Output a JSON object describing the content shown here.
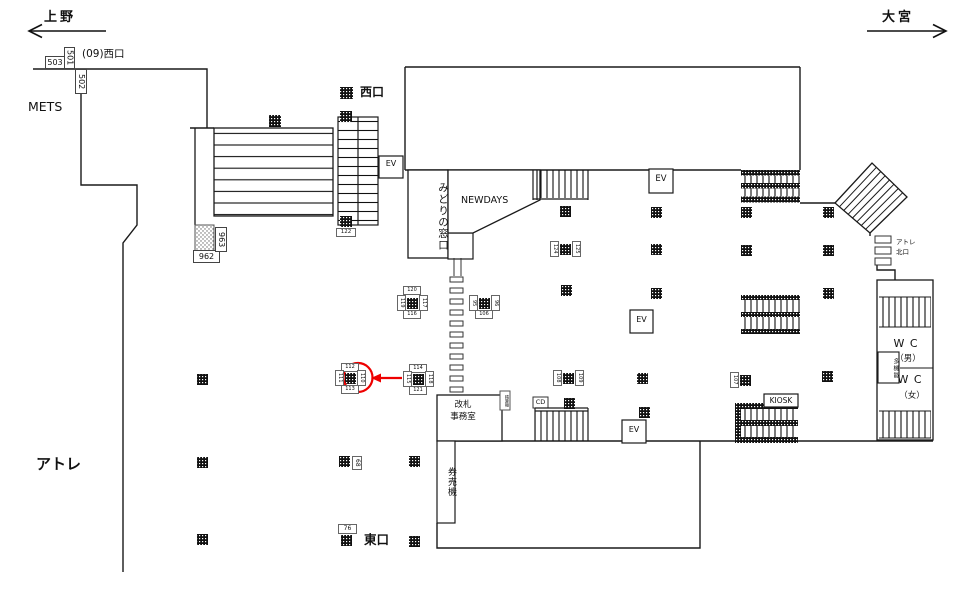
{
  "colors": {
    "wall": "#1a1a1a",
    "annotation": "#ee0000"
  },
  "directions": {
    "left": "上野",
    "right": "大宮"
  },
  "exits": {
    "west_note": "(09)西口",
    "west": "西口",
    "east": "東口"
  },
  "areas": {
    "mets": "METS",
    "atre": "アトレ",
    "atre_north_1": "アトレ",
    "atre_north_2": "北口",
    "midori": "みどりの窓口",
    "newdays": "NEWDAYS",
    "office": "改札\n事務室",
    "fare_adjust": "精算機",
    "ticket_machines": "券売機",
    "kiosk": "KIOSK",
    "cd": "CD",
    "ev": "EV",
    "wc": "W C",
    "wc_men": "（男）",
    "wc_women": "（女）",
    "multi": "多機能"
  },
  "ad_labels": {
    "n503": "503",
    "n501": "501",
    "n502": "502",
    "n962": "962",
    "n963": "963",
    "n122": "122",
    "n68": "68",
    "n76": "76",
    "c1": {
      "top": "120",
      "left": "119",
      "right": "117",
      "bottom": "116"
    },
    "c2": {
      "left": "95",
      "right": "96",
      "bottom": "106"
    },
    "c3": {
      "left": "124",
      "right": "125"
    },
    "c4": {
      "top": "112",
      "left": "111",
      "right": "110",
      "bottom": "113"
    },
    "c5": {
      "top": "114",
      "left": "115",
      "right": "118",
      "bottom": "121"
    },
    "c6": {
      "left": "108",
      "right": "109"
    },
    "c7": {
      "left": "107"
    }
  }
}
